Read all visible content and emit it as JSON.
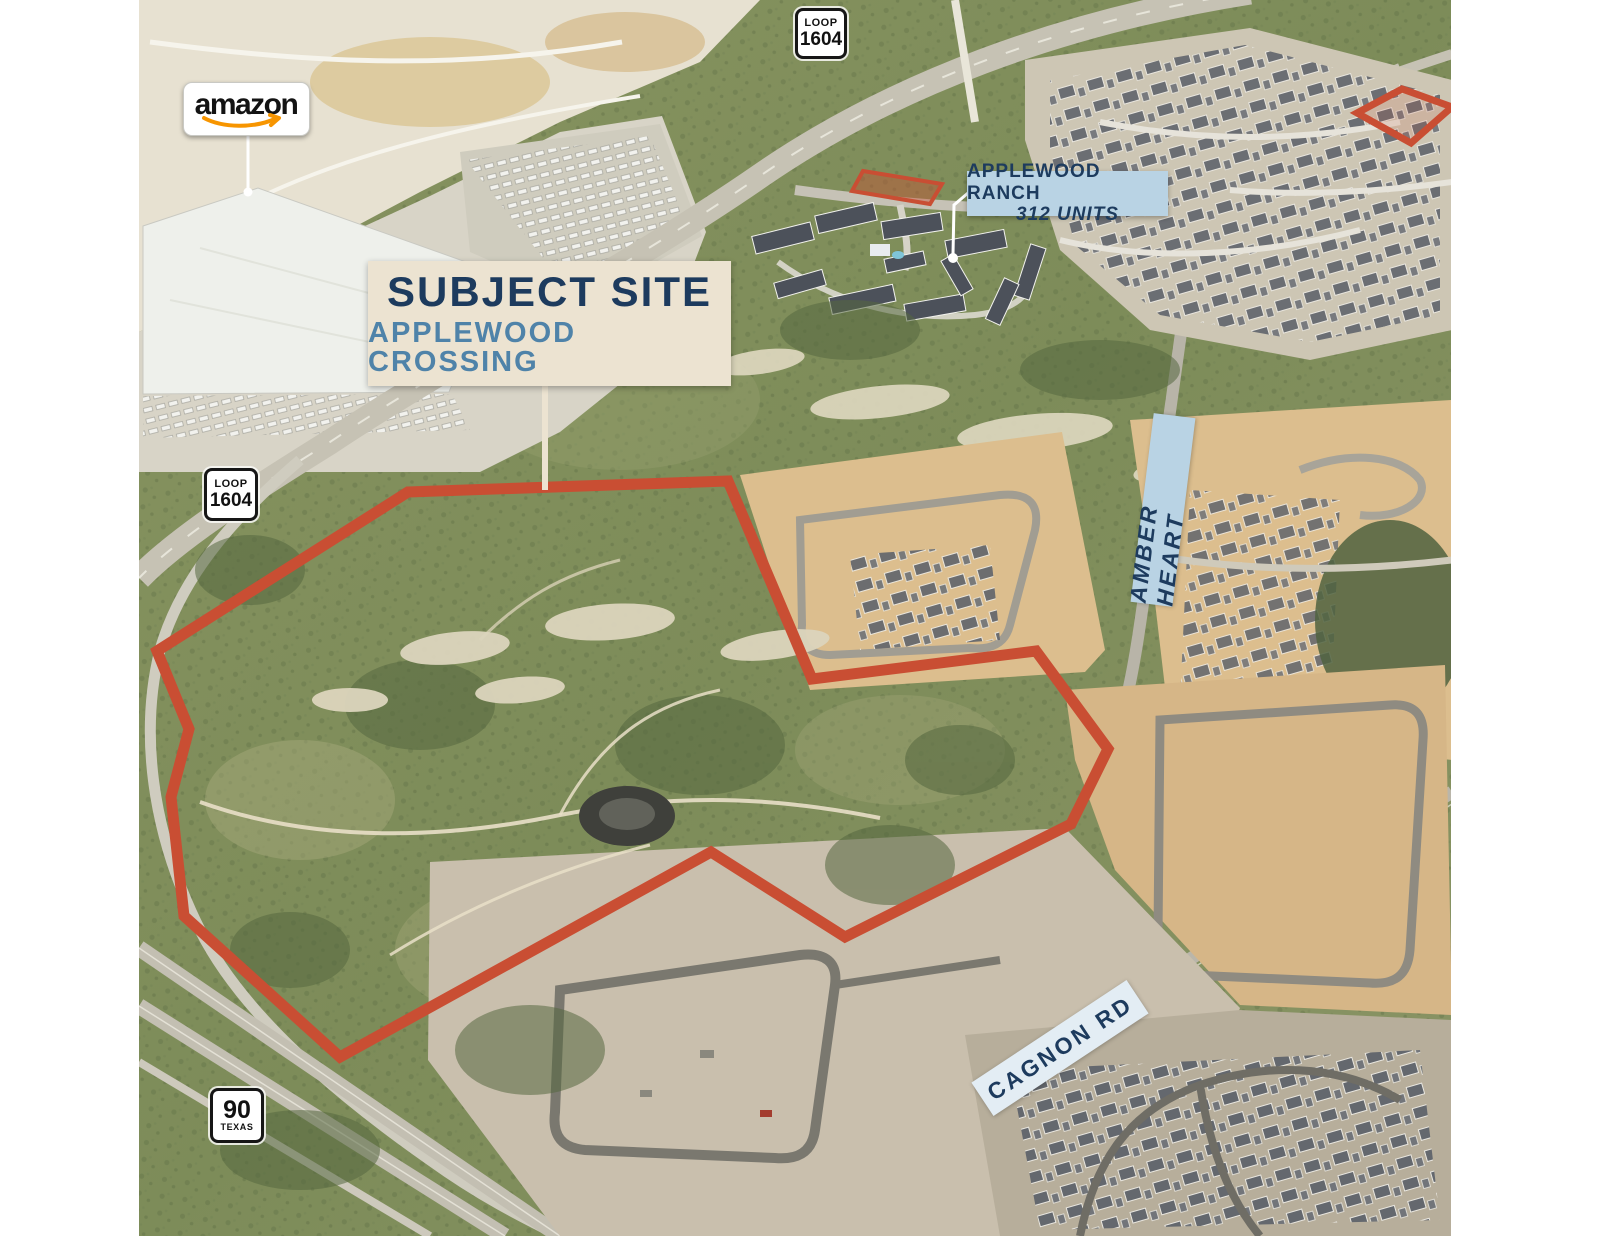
{
  "page": {
    "background": "#ffffff"
  },
  "aerial": {
    "description": "oblique aerial photo of Applewood Crossing site, far west San Antonio",
    "site_outline_color": "#c94e33",
    "outparcel_fill": "rgba(201,78,51,0.4)"
  },
  "callouts": {
    "amazon": {
      "logo_text": "amazon",
      "arrow_color": "#f79500"
    },
    "subject_site": {
      "title": "SUBJECT SITE",
      "subtitle": "APPLEWOOD CROSSING",
      "bg": "#ece3d1",
      "title_color": "#1d3b5e",
      "subtitle_color": "#4f83a9"
    },
    "applewood_ranch": {
      "title": "APPLEWOOD RANCH",
      "subtitle": "312 UNITS",
      "bg": "#b9d3e4",
      "text_color": "#1d3b5e"
    }
  },
  "road_labels": {
    "amber_heart": {
      "text": "AMBER HEART",
      "bg": "#b9d3e4",
      "text_color": "#1d3b5e"
    },
    "cagnon_rd": {
      "text": "CAGNON RD",
      "bg": "#e3edf4",
      "text_color": "#1d3b5e"
    }
  },
  "highway_shields": {
    "loop_1604_north": {
      "top": "LOOP",
      "number": "1604"
    },
    "loop_1604_west": {
      "top": "LOOP",
      "number": "1604"
    },
    "us_90": {
      "number": "90",
      "state": "TEXAS"
    }
  }
}
